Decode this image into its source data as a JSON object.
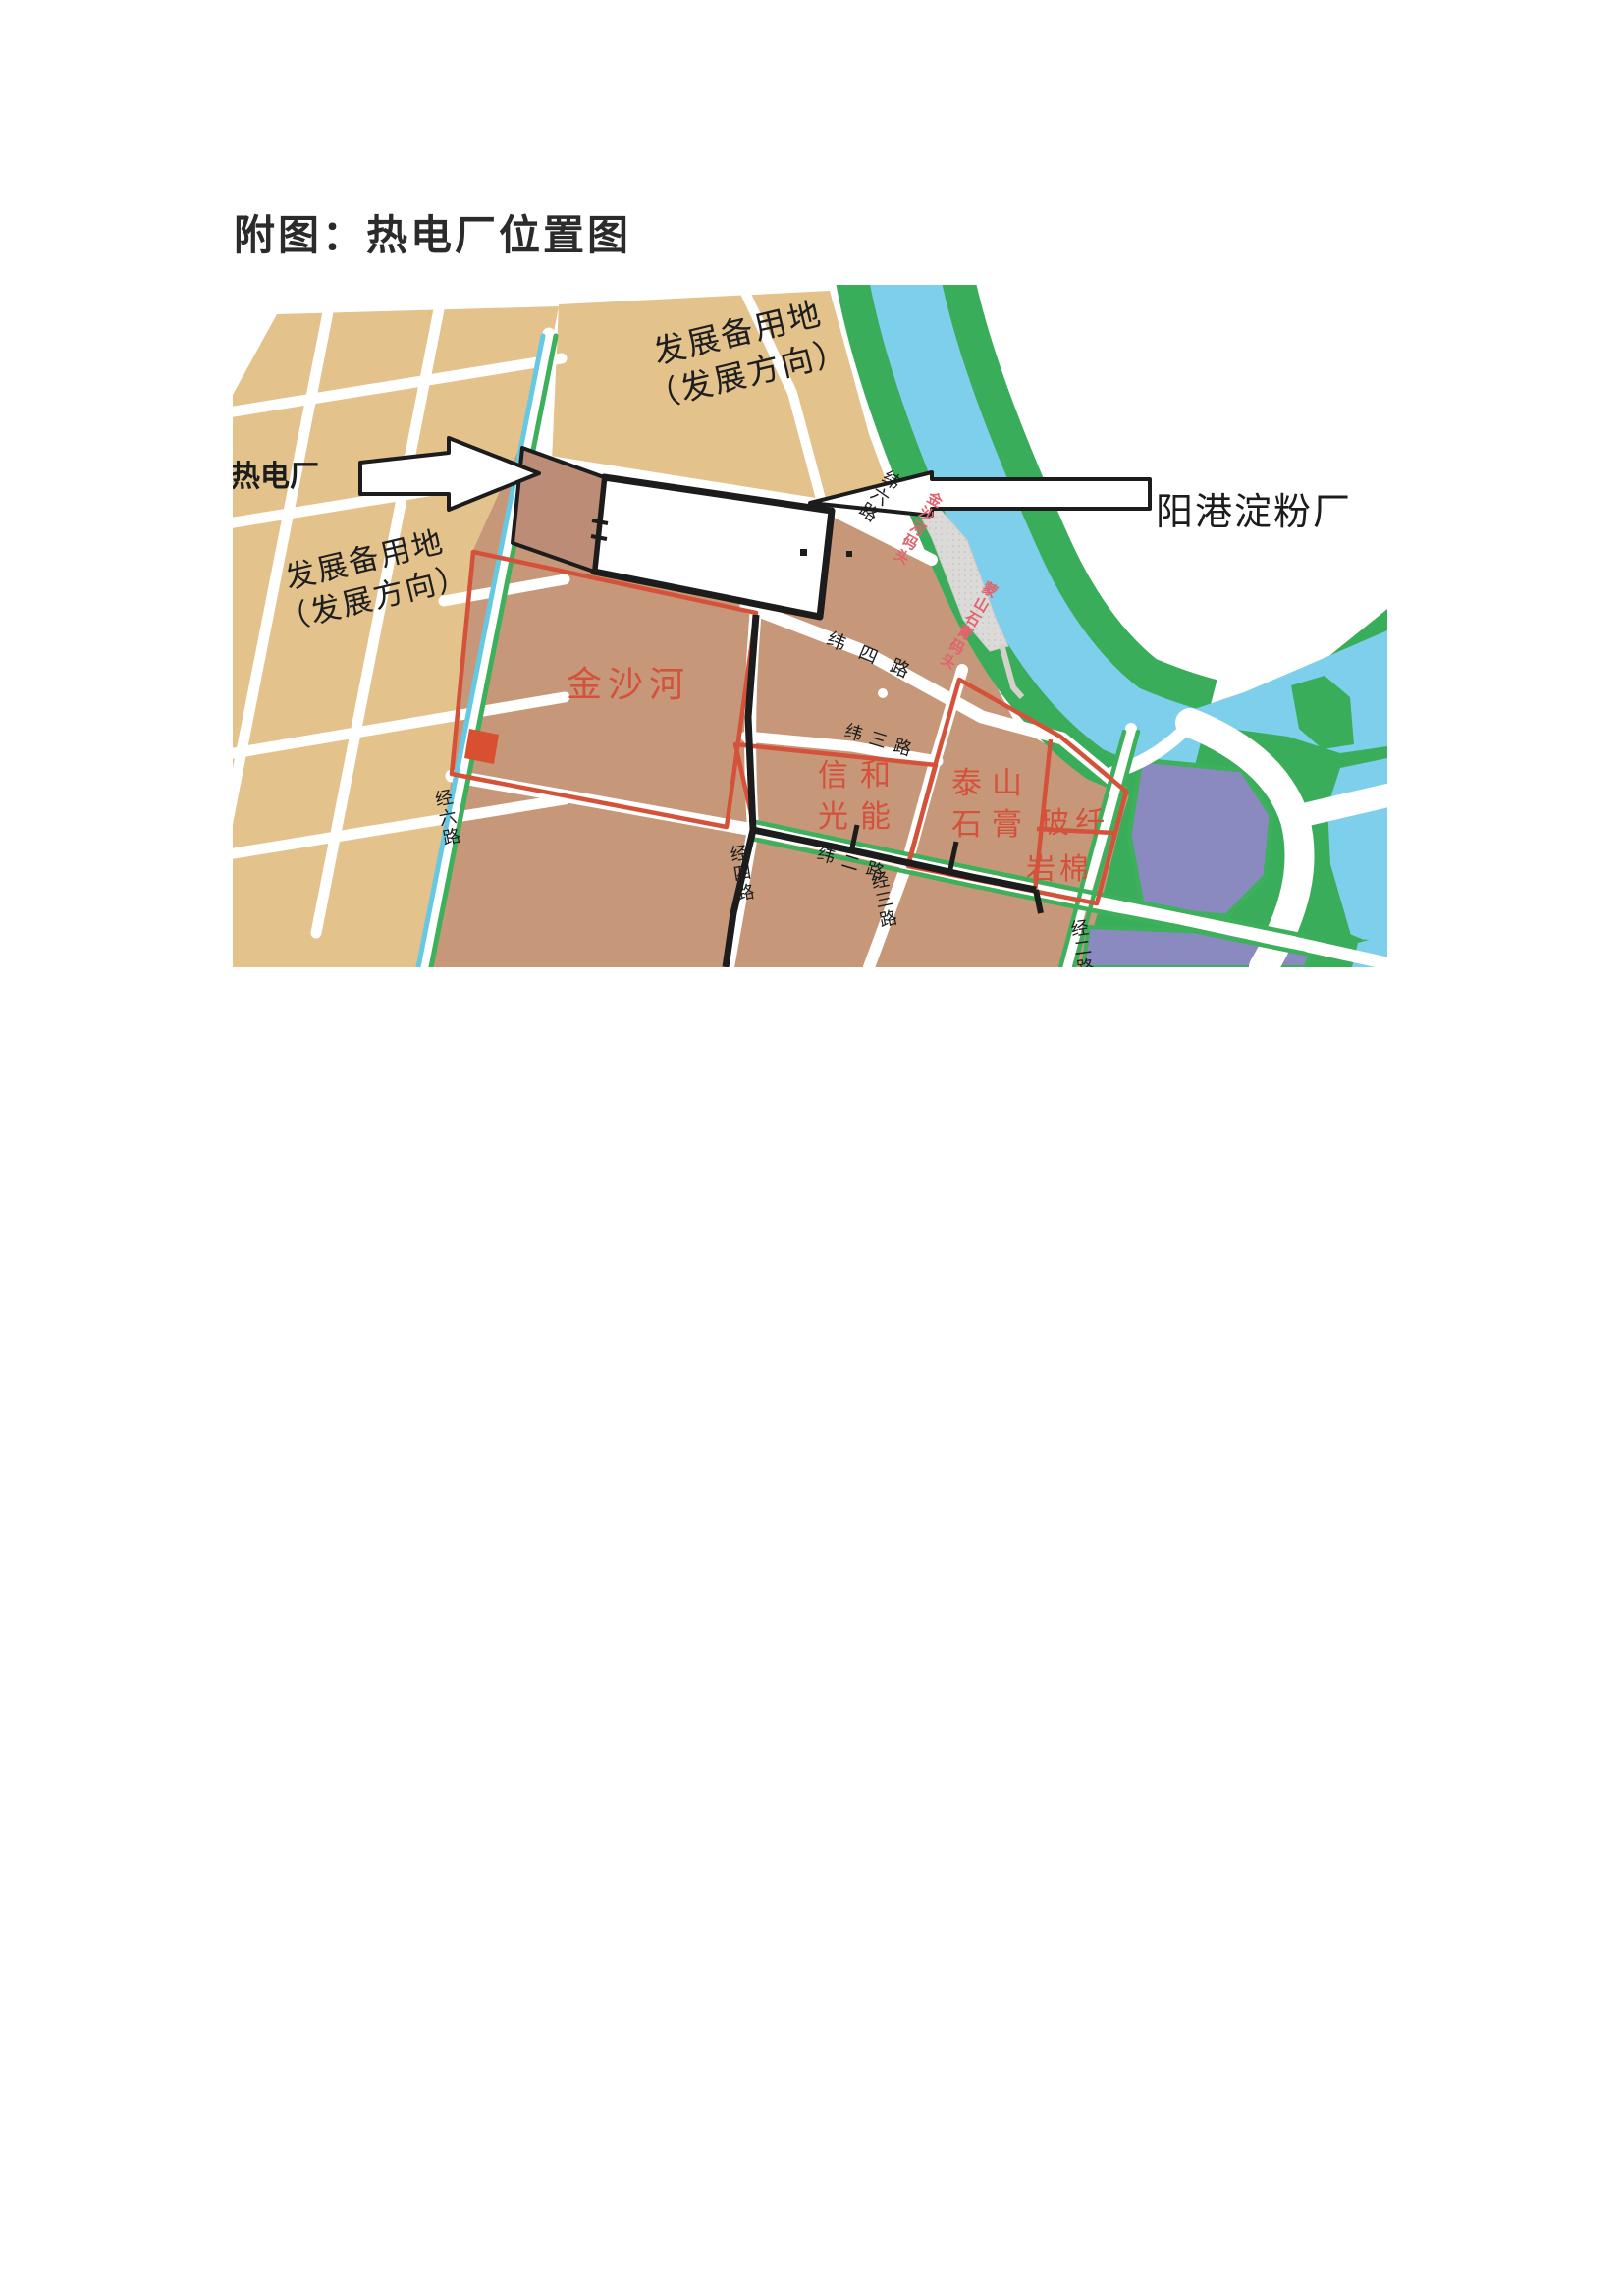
{
  "page": {
    "title": "附图：热电厂位置图"
  },
  "map": {
    "callouts": {
      "plant": "热电厂",
      "starch_factory": "阳港淀粉厂"
    },
    "areas": {
      "reserve_top_line1": "发展备用地",
      "reserve_top_line2": "（发展方向）",
      "reserve_left_line1": "发展备用地",
      "reserve_left_line2": "（发展方向）",
      "jinshahe": "金沙河",
      "xinhe_line1": "信和",
      "xinhe_line2": "光能",
      "taishan_line1": "泰山",
      "taishan_line2": "石膏",
      "boxian": "玻纤",
      "yanmian": "岩棉"
    },
    "roads": {
      "wei6": "纬六路",
      "wei4": "纬四路",
      "wei3": "纬三路",
      "wei2": "纬二路",
      "jing6": "经六路",
      "jing4": "经四路",
      "jing3": "经三路",
      "jing2": "经二路"
    },
    "docks": {
      "jinshahe_wharf": "金沙河码头",
      "mengshan_wharf": "蒙山石膏码头"
    },
    "colors": {
      "parcel_tan": "#e3c28c",
      "parcel_brown": "#c69879",
      "plant_brown": "#bc8c76",
      "red_border": "#d4523a",
      "red_text": "#d4513c",
      "river_green": "#3aad5b",
      "water_blue": "#7ecfeb",
      "purple_parcel": "#8a8ac0",
      "dock_gray": "#dcdad8",
      "canal_cyan": "#66c9e4",
      "stripe_green": "#3db05c",
      "boundary_black": "#1c1c1c"
    }
  }
}
